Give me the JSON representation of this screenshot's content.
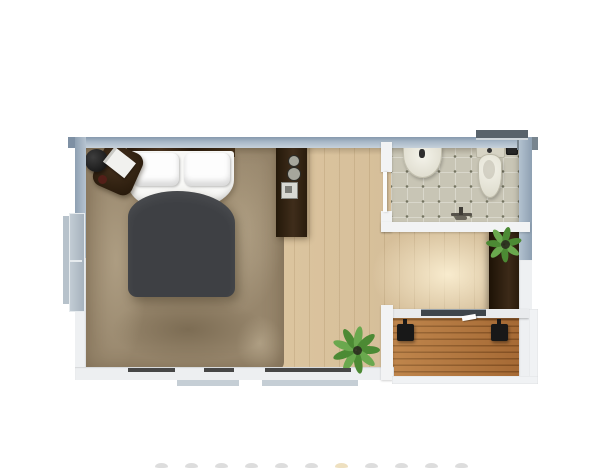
{
  "scene": {
    "kind": "floor-plan-render",
    "description": "Top-down 3D rendered floor plan of a studio suite: bedroom/living area with bed on shag rug, dark console, bathroom with sink and toilet, wardrobe with plant, floor plant, and wooden deck with sliding door and two stools",
    "visible_text": "none"
  },
  "colors": {
    "wallBlue": "#a9b9c8",
    "wallBlueDark": "#7e90a4",
    "wallWhite": "#eef0f2",
    "windowDark": "#59636b",
    "windowGray": "#c2ccd4",
    "woodFloor": "#ddc7a4",
    "rugBase": "#97866c",
    "tileFloor": "#c8c5b5",
    "fixtureCream": "#edece1",
    "duvetGray": "#3e4044",
    "linenWhite": "#f8f8f6",
    "headboardBrown": "#3a2817",
    "darkWood": "#2f2012",
    "deckWood": "#b1743c",
    "plantGreen": "#4c8a34",
    "plantGreenLight": "#6aa84e",
    "accentBlack": "#181818"
  },
  "rooms": [
    {
      "name": "bedroom-living-area",
      "floor": "light wood planks with brown shag rug"
    },
    {
      "name": "bathroom",
      "floor": "tile with dot grid"
    },
    {
      "name": "deck",
      "floor": "hardwood deck boards"
    }
  ],
  "objects": [
    {
      "name": "double-bed"
    },
    {
      "name": "bedside-table-with-lamp-and-book"
    },
    {
      "name": "area-rug"
    },
    {
      "name": "console-cabinet"
    },
    {
      "name": "bathroom-sink"
    },
    {
      "name": "toilet"
    },
    {
      "name": "waste-bin"
    },
    {
      "name": "floor-faucet"
    },
    {
      "name": "wardrobe"
    },
    {
      "name": "potted-plant-on-wardrobe"
    },
    {
      "name": "floor-plant"
    },
    {
      "name": "sliding-door"
    },
    {
      "name": "deck-stool-left"
    },
    {
      "name": "deck-stool-right"
    }
  ],
  "windows": [
    "top-wall-window",
    "left-wall-window",
    "bottom-wall-windows"
  ],
  "faint_marks": {
    "count": 11
  }
}
